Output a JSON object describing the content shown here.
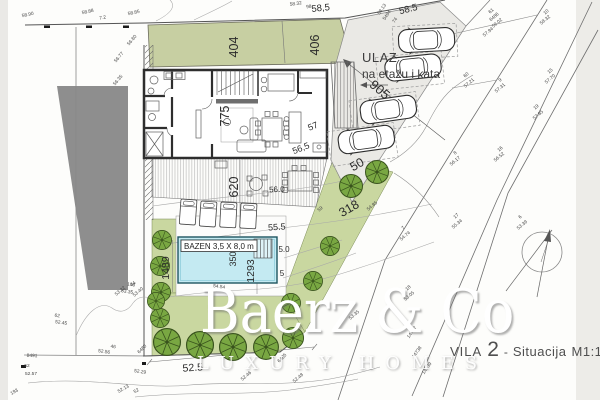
{
  "title": {
    "project": "VILA",
    "number": "2",
    "dash": "-",
    "name": "Situacija",
    "scale": "M1:120"
  },
  "watermark": {
    "brand": "Baerz & Co",
    "tagline": "LUXURY HOMES"
  },
  "entrance": {
    "line1": "ULAZ",
    "line2": "na etažu i kata"
  },
  "pool": {
    "label": "BAZEN 3,5 X 8,0 m"
  },
  "colors": {
    "green_top": "#c7cfa2",
    "green": "#c9d7a0",
    "tree_fill": "#79a742",
    "tree_stroke": "#39531d",
    "pool_water": "#c4eaf2",
    "parking_bg": "#eae9e5",
    "building_gray": "#8e8e8e",
    "boundary": "#555555",
    "text": "#2b2b2b",
    "margin": "#eae9e6"
  },
  "dimension_labels": [
    {
      "text": "404",
      "x": 238,
      "y": 47,
      "rot": -90,
      "size": 12.5
    },
    {
      "text": "406",
      "x": 319,
      "y": 45,
      "rot": -90,
      "size": 12.5
    },
    {
      "text": "775",
      "x": 229,
      "y": 116,
      "rot": -90,
      "size": 12.5
    },
    {
      "text": "620",
      "x": 238,
      "y": 187,
      "rot": -90,
      "size": 12.5
    },
    {
      "text": "905",
      "x": 377,
      "y": 93,
      "rot": 40,
      "size": 13
    },
    {
      "text": "1489",
      "x": 169,
      "y": 268,
      "rot": -90,
      "size": 10.5
    },
    {
      "text": "1293",
      "x": 254,
      "y": 271,
      "rot": -90,
      "size": 10.5
    },
    {
      "text": "350",
      "x": 236,
      "y": 259,
      "rot": -90,
      "size": 9
    },
    {
      "text": "318",
      "x": 351,
      "y": 212,
      "rot": -30,
      "size": 12.5
    },
    {
      "text": "50",
      "x": 359,
      "y": 168,
      "rot": -30,
      "size": 12.5
    },
    {
      "text": "58,5",
      "x": 321,
      "y": 11,
      "rot": -6,
      "size": 9.5
    },
    {
      "text": "58.5",
      "x": 409,
      "y": 12,
      "rot": -14,
      "size": 9.5
    },
    {
      "text": "52.5",
      "x": 193,
      "y": 371,
      "rot": -4,
      "size": 10.5
    },
    {
      "text": "55.5",
      "x": 277,
      "y": 230,
      "rot": -4,
      "size": 9
    },
    {
      "text": "56.0",
      "x": 277,
      "y": 192,
      "rot": -3,
      "size": 8
    },
    {
      "text": "5.0",
      "x": 284,
      "y": 252,
      "rot": 0,
      "size": 8
    },
    {
      "text": "5",
      "x": 282,
      "y": 276,
      "rot": 0,
      "size": 8
    },
    {
      "text": "56,5",
      "x": 302,
      "y": 151,
      "rot": -22,
      "size": 9
    },
    {
      "text": "57",
      "x": 314,
      "y": 129,
      "rot": -22,
      "size": 9
    }
  ],
  "spot_heights": [
    {
      "t": "58.90",
      "x": 28,
      "y": 16,
      "r": -12
    },
    {
      "t": "58.88",
      "x": 88,
      "y": 13,
      "r": -12
    },
    {
      "t": "7.2",
      "x": 103,
      "y": 19,
      "r": -12
    },
    {
      "t": "58.85",
      "x": 134,
      "y": 14,
      "r": -12
    },
    {
      "t": "56.80",
      "x": 133,
      "y": 41,
      "r": -50
    },
    {
      "t": "56.77",
      "x": 120,
      "y": 58,
      "r": -50
    },
    {
      "t": "56.35",
      "x": 119,
      "y": 81,
      "r": -50
    },
    {
      "t": "58.32",
      "x": 296,
      "y": 5,
      "r": -8
    },
    {
      "t": "98",
      "x": 309,
      "y": 8,
      "r": -8
    },
    {
      "t": "58.13",
      "x": 383,
      "y": 10,
      "r": -55
    },
    {
      "t": "5494",
      "x": 388,
      "y": 16,
      "r": -55
    },
    {
      "t": "74",
      "x": 396,
      "y": 21,
      "r": -55
    },
    {
      "t": "61",
      "x": 492,
      "y": 12,
      "r": -40
    },
    {
      "t": "6486",
      "x": 495,
      "y": 18,
      "r": -40
    },
    {
      "t": "59.02",
      "x": 498,
      "y": 24,
      "r": -40
    },
    {
      "t": "57.94",
      "x": 489,
      "y": 33,
      "r": -40
    },
    {
      "t": "10",
      "x": 547,
      "y": 13,
      "r": -40
    },
    {
      "t": "58.32",
      "x": 546,
      "y": 21,
      "r": -40
    },
    {
      "t": "60",
      "x": 467,
      "y": 76,
      "r": -40
    },
    {
      "t": "57.21",
      "x": 470,
      "y": 84,
      "r": -40
    },
    {
      "t": "9",
      "x": 501,
      "y": 81,
      "r": -40
    },
    {
      "t": "57.31",
      "x": 501,
      "y": 89,
      "r": -40
    },
    {
      "t": "15",
      "x": 551,
      "y": 72,
      "r": -40
    },
    {
      "t": "57.70",
      "x": 551,
      "y": 80,
      "r": -40
    },
    {
      "t": "19",
      "x": 537,
      "y": 108,
      "r": -40
    },
    {
      "t": "57.85",
      "x": 539,
      "y": 116,
      "r": -40
    },
    {
      "t": "8",
      "x": 456,
      "y": 154,
      "r": -40
    },
    {
      "t": "56.17",
      "x": 456,
      "y": 162,
      "r": -40
    },
    {
      "t": "16",
      "x": 501,
      "y": 150,
      "r": -40
    },
    {
      "t": "56.52",
      "x": 500,
      "y": 158,
      "r": -40
    },
    {
      "t": "17",
      "x": 457,
      "y": 217,
      "r": -40
    },
    {
      "t": "55.34",
      "x": 458,
      "y": 225,
      "r": -40
    },
    {
      "t": "7",
      "x": 404,
      "y": 229,
      "r": -40
    },
    {
      "t": "54.74",
      "x": 406,
      "y": 237,
      "r": -40
    },
    {
      "t": "18",
      "x": 409,
      "y": 289,
      "r": -40
    },
    {
      "t": "53.05",
      "x": 410,
      "y": 297,
      "r": -40
    },
    {
      "t": "6",
      "x": 521,
      "y": 218,
      "r": -40
    },
    {
      "t": "53.39",
      "x": 523,
      "y": 226,
      "r": -40
    },
    {
      "t": "8",
      "x": 352,
      "y": 308,
      "r": -40
    },
    {
      "t": "53.35",
      "x": 355,
      "y": 316,
      "r": -40
    },
    {
      "t": "14737",
      "x": 413,
      "y": 333,
      "r": -55
    },
    {
      "t": "14738",
      "x": 418,
      "y": 353,
      "r": -55
    },
    {
      "t": "14739",
      "x": 428,
      "y": 369,
      "r": -55
    },
    {
      "t": "103",
      "x": 131,
      "y": 286,
      "r": 8
    },
    {
      "t": "53.35",
      "x": 127,
      "y": 293,
      "r": 8
    },
    {
      "t": "62",
      "x": 57,
      "y": 317,
      "r": 8
    },
    {
      "t": "52.45",
      "x": 61,
      "y": 324,
      "r": 8
    },
    {
      "t": "46",
      "x": 113,
      "y": 348,
      "r": 8
    },
    {
      "t": "52.56",
      "x": 104,
      "y": 353,
      "r": 8
    },
    {
      "t": "52",
      "x": 27,
      "y": 367,
      "r": 0
    },
    {
      "t": "52.57",
      "x": 31,
      "y": 375,
      "r": 0
    },
    {
      "t": "52.29",
      "x": 140,
      "y": 373,
      "r": 8
    },
    {
      "t": "44",
      "x": 134,
      "y": 285,
      "r": -40
    },
    {
      "t": "53.22",
      "x": 121,
      "y": 292,
      "r": -40
    },
    {
      "t": "53.40",
      "x": 139,
      "y": 293,
      "r": -40
    },
    {
      "t": "6480",
      "x": 143,
      "y": 350,
      "r": -45
    },
    {
      "t": "6485",
      "x": 283,
      "y": 359,
      "r": -45
    },
    {
      "t": "54.54",
      "x": 219,
      "y": 288,
      "r": 8
    },
    {
      "t": "54.85",
      "x": 373,
      "y": 207,
      "r": -40
    },
    {
      "t": "59",
      "x": 321,
      "y": 210,
      "r": -40
    },
    {
      "t": "52.13",
      "x": 124,
      "y": 390,
      "r": -30
    },
    {
      "t": "52",
      "x": 137,
      "y": 392,
      "r": -30
    },
    {
      "t": "52.46",
      "x": 247,
      "y": 377,
      "r": -40
    },
    {
      "t": "52.48",
      "x": 299,
      "y": 379,
      "r": -40
    },
    {
      "t": "8491",
      "x": 32,
      "y": 357,
      "r": 3
    },
    {
      "t": "193",
      "x": 15,
      "y": 393,
      "r": -30
    }
  ],
  "trees": [
    {
      "x": 162,
      "y": 240,
      "r": 10
    },
    {
      "x": 160,
      "y": 266,
      "r": 10
    },
    {
      "x": 161,
      "y": 292,
      "r": 10
    },
    {
      "x": 160,
      "y": 318,
      "r": 10
    },
    {
      "x": 167,
      "y": 342,
      "r": 14
    },
    {
      "x": 156,
      "y": 301,
      "r": 9
    },
    {
      "x": 200,
      "y": 345,
      "r": 14
    },
    {
      "x": 233,
      "y": 347,
      "r": 14
    },
    {
      "x": 266,
      "y": 347,
      "r": 13
    },
    {
      "x": 293,
      "y": 338,
      "r": 11
    },
    {
      "x": 377,
      "y": 172,
      "r": 12
    },
    {
      "x": 351,
      "y": 186,
      "r": 12
    },
    {
      "x": 330,
      "y": 246,
      "r": 10
    },
    {
      "x": 313,
      "y": 281,
      "r": 10
    },
    {
      "x": 291,
      "y": 303,
      "r": 10
    }
  ],
  "cars": [
    {
      "x": 398,
      "y": 30,
      "rot": -3
    },
    {
      "x": 384,
      "y": 59,
      "rot": -6
    },
    {
      "x": 359,
      "y": 102,
      "rot": -8
    },
    {
      "x": 337,
      "y": 132,
      "rot": -8
    }
  ],
  "loungers": [
    {
      "x": 181,
      "y": 199,
      "rot": 4
    },
    {
      "x": 201,
      "y": 201,
      "rot": 4
    },
    {
      "x": 221,
      "y": 202,
      "rot": 3
    },
    {
      "x": 241,
      "y": 203,
      "rot": 3
    }
  ],
  "parking_bays": [
    {
      "x": 393,
      "y": 25,
      "w": 64,
      "h": 33,
      "rot": -3
    },
    {
      "x": 377,
      "y": 54,
      "w": 66,
      "h": 33,
      "rot": -6
    },
    {
      "x": 351,
      "y": 96,
      "w": 67,
      "h": 34,
      "rot": -8
    },
    {
      "x": 329,
      "y": 127,
      "w": 67,
      "h": 35,
      "rot": -8
    }
  ],
  "survey_markers": [
    {
      "x": 44,
      "y": 25.5,
      "w": 6,
      "h": 2.5
    },
    {
      "x": 86,
      "y": 25.5,
      "w": 6,
      "h": 2.5
    },
    {
      "x": 123,
      "y": 25.5,
      "w": 6,
      "h": 2.5
    },
    {
      "x": 21,
      "y": 365,
      "w": 5,
      "h": 3
    },
    {
      "x": 142,
      "y": 362,
      "w": 4,
      "h": 3
    }
  ]
}
